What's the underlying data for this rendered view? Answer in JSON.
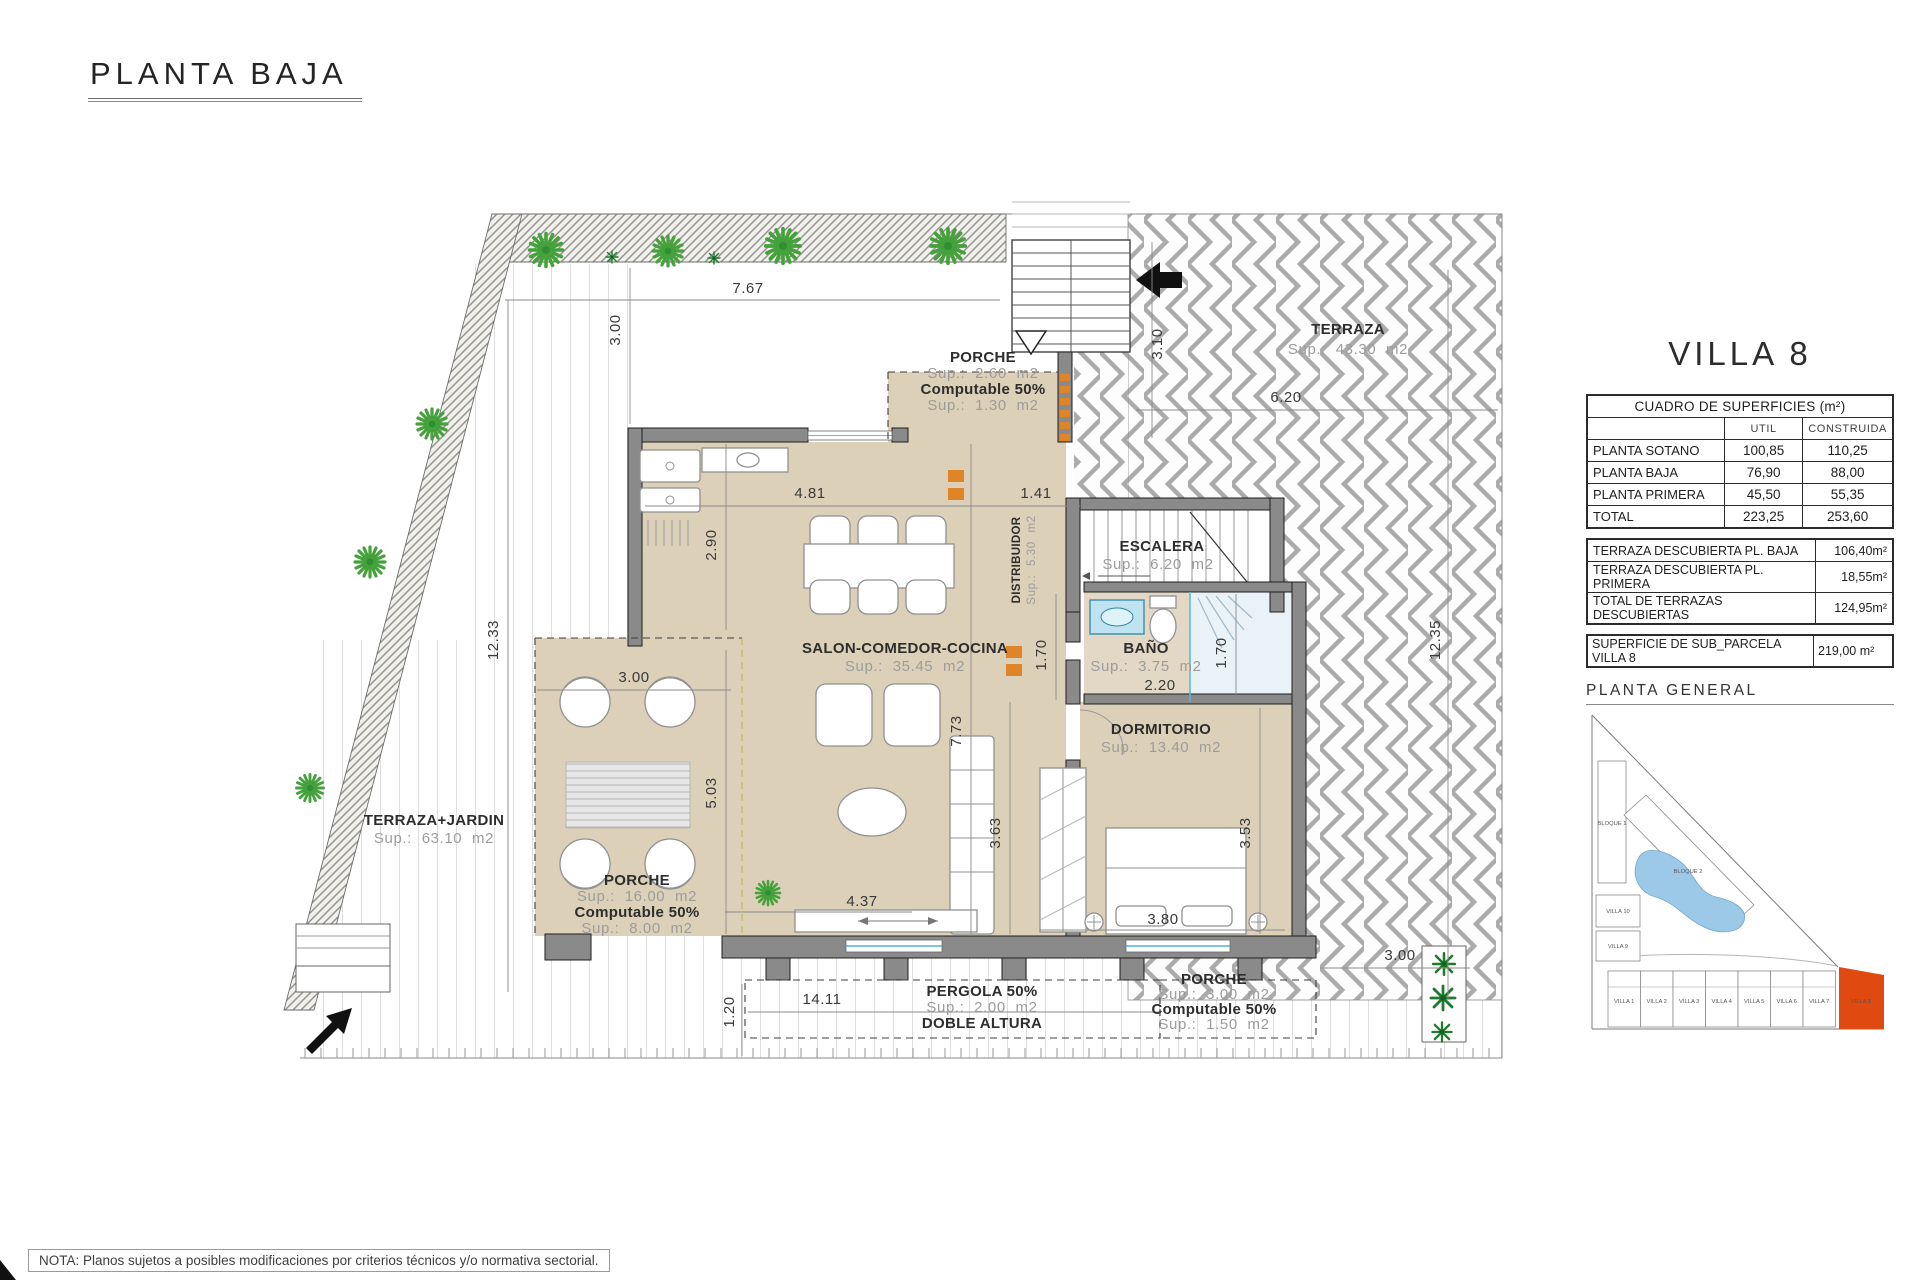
{
  "page": {
    "title": "PLANTA BAJA",
    "note": "NOTA: Planos sujetos a posibles modificaciones por criterios técnicos y/o normativa sectorial."
  },
  "panel": {
    "villa_title": "VILLA 8",
    "surfaces_table": {
      "title": "CUADRO DE SUPERFICIES (m²)",
      "col_util": "UTIL",
      "col_construida": "CONSTRUIDA",
      "rows": [
        {
          "label": "PLANTA SOTANO",
          "util": "100,85",
          "construida": "110,25"
        },
        {
          "label": "PLANTA BAJA",
          "util": "76,90",
          "construida": "88,00"
        },
        {
          "label": "PLANTA PRIMERA",
          "util": "45,50",
          "construida": "55,35"
        },
        {
          "label": "TOTAL",
          "util": "223,25",
          "construida": "253,60"
        }
      ]
    },
    "terraces": [
      {
        "label": "TERRAZA DESCUBIERTA PL. BAJA",
        "value": "106,40m²"
      },
      {
        "label": "TERRAZA DESCUBIERTA PL. PRIMERA",
        "value": "18,55m²"
      },
      {
        "label": "TOTAL DE TERRAZAS DESCUBIERTAS",
        "value": "124,95m²"
      }
    ],
    "parcel": {
      "label": "SUPERFICIE DE SUB_PARCELA VILLA 8",
      "value": "219,00 m²"
    },
    "site_plan_title": "PLANTA GENERAL",
    "site_plan": {
      "bloque1": "BLOQUE 1",
      "bloque2": "BLOQUE 2",
      "villa10": "VILLA 10",
      "villa9": "VILLA 9",
      "bottom_villas": [
        "VILLA 1",
        "VILLA 2",
        "VILLA 3",
        "VILLA 4",
        "VILLA 5",
        "VILLA 6",
        "VILLA 7"
      ],
      "highlighted": "VILLA 8",
      "highlight_color": "#e0490f",
      "pool_color": "#9cc9e8"
    }
  },
  "plan": {
    "rooms": {
      "porche_top": {
        "name": "PORCHE",
        "area": "Sup.: 2.60 m2",
        "c1": "Computable 50%",
        "c2": "Sup.: 1.30 m2"
      },
      "terraza": {
        "name": "TERRAZA",
        "area": "Sup.: 43.30 m2"
      },
      "salon": {
        "name": "SALON-COMEDOR-COCINA",
        "area": "Sup.: 35.45 m2"
      },
      "escalera": {
        "name": "ESCALERA",
        "area": "Sup.: 6.20 m2"
      },
      "distribuidor": {
        "name": "DISTRIBUIDOR",
        "area": "Sup.: 5.30 m2"
      },
      "bano": {
        "name": "BAÑO",
        "area": "Sup.: 3.75 m2"
      },
      "dormitorio": {
        "name": "DORMITORIO",
        "area": "Sup.: 13.40 m2"
      },
      "terraza_jardin": {
        "name": "TERRAZA+JARDIN",
        "area": "Sup.: 63.10 m2"
      },
      "porche_left": {
        "name": "PORCHE",
        "area": "Sup.: 16.00 m2",
        "c1": "Computable 50%",
        "c2": "Sup.: 8.00 m2"
      },
      "pergola": {
        "name": "PERGOLA 50%",
        "area": "Sup.: 2.00 m2",
        "c1": "DOBLE ALTURA"
      },
      "porche_bottom": {
        "name": "PORCHE",
        "area": "Sup.: 3.00 m2",
        "c1": "Computable 50%",
        "c2": "Sup.: 1.50 m2"
      }
    },
    "dims": {
      "top_width": "7.67",
      "top_garden_depth": "3.00",
      "left_height": "12.33",
      "salon_width": "4.81",
      "kitchen_depth": "2.90",
      "hall_width": "1.41",
      "stairs_side": "3.10",
      "terraza_width": "6.20",
      "porche_width": "3.00",
      "porche_height": "5.03",
      "salon_height": "7.73",
      "bath_left": "1.70",
      "bath_width": "2.20",
      "bath_right": "1.70",
      "salon_lower": "3.63",
      "dorm_height": "3.53",
      "bed_width": "3.80",
      "salon_bottom": "4.37",
      "bottom_width": "14.11",
      "pergola_offset": "1.20",
      "bottom_right": "3.00",
      "right_height": "12.35"
    }
  }
}
